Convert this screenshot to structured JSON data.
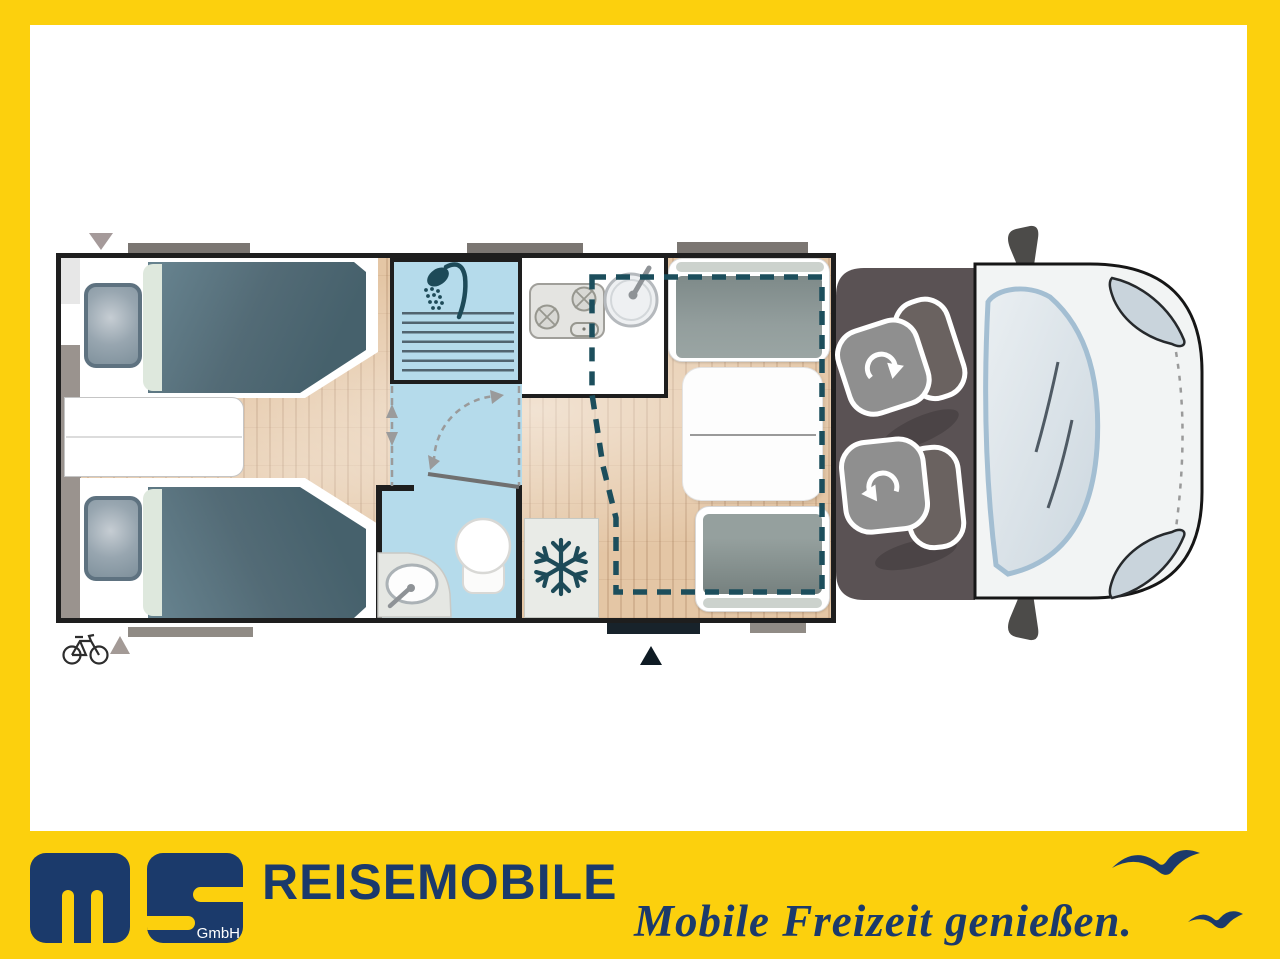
{
  "branding": {
    "logo_monogram": "ms",
    "logo_suffix": "GmbH",
    "wordmark": "REISEMOBILE",
    "slogan": "Mobile Freizeit genießen.",
    "navy": "#1b3a6b",
    "frame_yellow": "#fcd00d"
  },
  "floorplan": {
    "description": "Top-view floor plan of a semi-integrated motorhome with the driver cab on the right",
    "features": [
      {
        "name": "rear-twin-single-beds",
        "detail": "two single beds with slate duvets and pillows, step cabinet between them"
      },
      {
        "name": "shower-cubicle",
        "detail": "blue wet room cell with shower-head symbol and ribbed shower tray"
      },
      {
        "name": "washroom",
        "detail": "toilet bowl and oval wash basin with faucet"
      },
      {
        "name": "kitchen-block",
        "detail": "two-burner hob and round sink with faucet"
      },
      {
        "name": "refrigerator",
        "detail": "cabinet marked with snowflake symbol"
      },
      {
        "name": "half-dinette",
        "detail": "two facing bench seats with table between"
      },
      {
        "name": "drop-down-bed",
        "detail": "teal dashed outline above dinette area"
      },
      {
        "name": "driver-cab",
        "detail": "two swivel seats marked with rotation arrows"
      },
      {
        "name": "entrance-door",
        "detail": "dark bar with black arrow at bottom wall"
      },
      {
        "name": "bike-rack-marker",
        "detail": "bicycle symbol with gray arrow at rear left"
      },
      {
        "name": "awning-rail-bars",
        "detail": "gray bars along top and bottom exterior walls"
      }
    ],
    "colors": {
      "wet_room_blue": "#b5dbeb",
      "accent_teal": "#1d4a58",
      "bed_slate": "#54707c",
      "floor_wood": "#e4c6a5",
      "cab_gray": "#5a5254",
      "cushion_gray": "#8f9998"
    }
  }
}
